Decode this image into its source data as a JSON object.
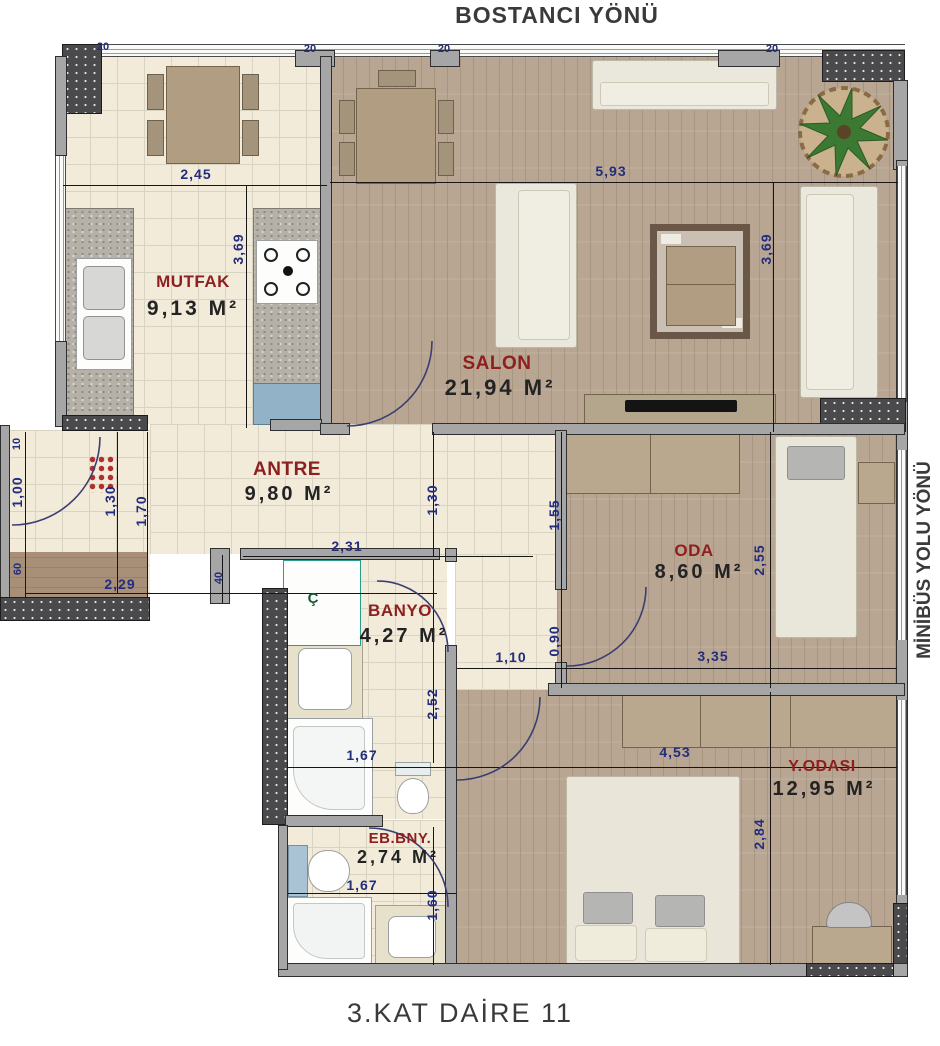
{
  "titles": {
    "top": "BOSTANCI YÖNÜ",
    "right": "MİNİBÜS YOLU YÖNÜ",
    "bottom": "3.KAT DAİRE 11"
  },
  "rooms": [
    {
      "name": "MUTFAK",
      "area": "9,13 M²"
    },
    {
      "name": "SALON",
      "area": "21,94 M²"
    },
    {
      "name": "ANTRE",
      "area": "9,80 M²"
    },
    {
      "name": "ODA",
      "area": "8,60 M²"
    },
    {
      "name": "BANYO",
      "area": "4,27 M²"
    },
    {
      "name": "Y.ODASI",
      "area": "12,95 M²"
    },
    {
      "name": "EB.BNY.",
      "area": "2,74 M²"
    }
  ],
  "closet_label": "Ç",
  "dims": [
    "20",
    "20",
    "20",
    "20",
    "2,45",
    "5,93",
    "3,69",
    "3,69",
    "10",
    "1,00",
    "1,30",
    "1,70",
    "60",
    "2,29",
    "40",
    "2,31",
    "1,30",
    "1,55",
    "2,55",
    "3,35",
    "0,90",
    "1,10",
    "2,52",
    "1,67",
    "4,53",
    "2,84",
    "1,67",
    "1,60"
  ],
  "colors": {
    "dimension_text": "#232d7d",
    "room_name": "#8e1f1f",
    "area_text": "#232323",
    "title_text": "#3a3a3c",
    "wall_fill": "#a6a6a6",
    "concrete_fill": "#4a4a4d",
    "tile_floor": "#f2ebda",
    "wood_floor": "#b9a692",
    "door_arc": "#3a3f72",
    "closet_border": "#2a9d8f"
  }
}
